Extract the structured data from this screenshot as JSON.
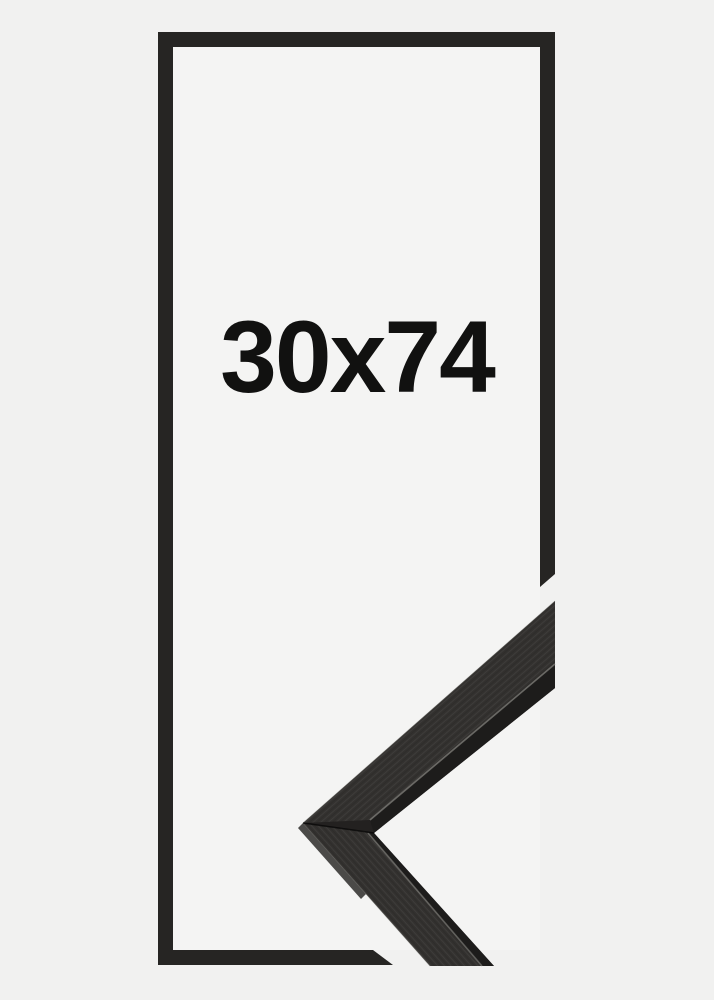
{
  "product": {
    "size_label": "30x74"
  },
  "colors": {
    "background": "#f1f1f0",
    "inner_background": "#f4f4f3",
    "frame_black": "#262523",
    "corner_base": "#232120",
    "corner_face": "#33312f",
    "corner_edge_strip": "#1d1c1b",
    "corner_highlight": "#8f8e89",
    "corner_outer_bevel": "#4b4a48",
    "label_text": "#111110"
  }
}
